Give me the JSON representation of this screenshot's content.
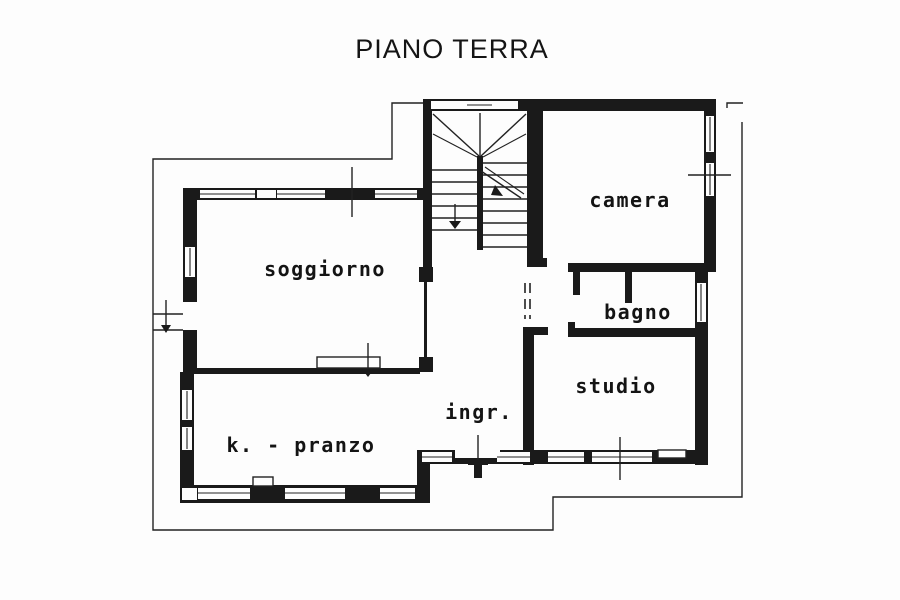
{
  "title": "PIANO TERRA",
  "rooms": {
    "soggiorno": {
      "label": "soggiorno"
    },
    "camera": {
      "label": "camera"
    },
    "bagno": {
      "label": "bagno"
    },
    "studio": {
      "label": "studio"
    },
    "ingresso": {
      "label": "ingr."
    },
    "kitchen_pranzo": {
      "label": "k. - pranzo"
    }
  },
  "colors": {
    "bg": "#fdfdfd",
    "wall": "#1a1a1a",
    "line": "#222222",
    "text": "#141414"
  }
}
